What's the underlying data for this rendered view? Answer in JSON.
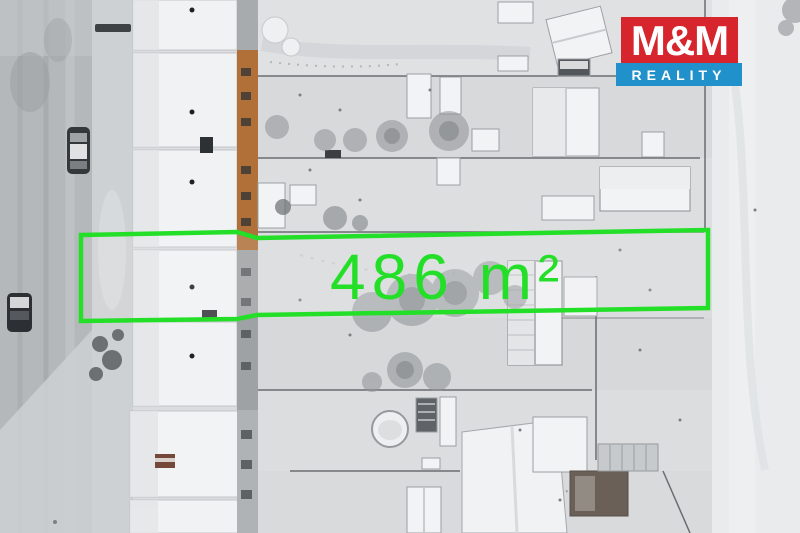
{
  "overlay": {
    "area_label": "486 m²"
  },
  "logo": {
    "line1": "M&M",
    "line2": "REALITY"
  },
  "colors": {
    "accent": "#24df28",
    "logo-red": "#d6252d",
    "logo-blue": "#2191cb",
    "logo-text": "#ffffff"
  }
}
